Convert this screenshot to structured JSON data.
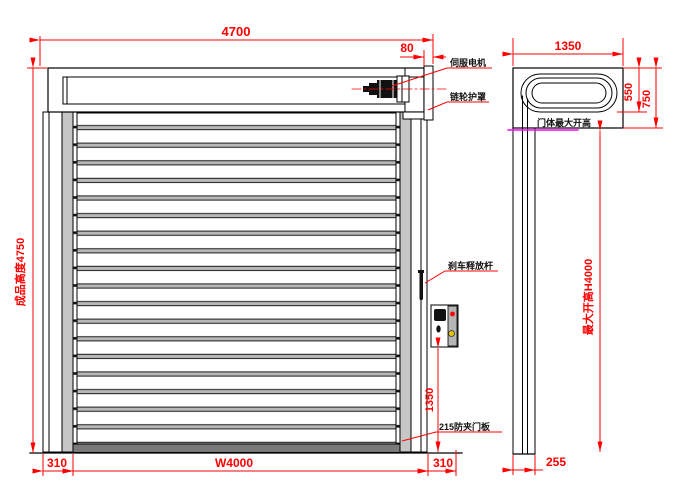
{
  "title": "高速卷帘门外形尺寸图",
  "front_view": {
    "dims": {
      "total_width": "4700",
      "bracket_width": "80",
      "product_height": "成品高度4750",
      "box_to_floor": "1350",
      "left_margin": "310",
      "opening_width": "W4000",
      "right_margin": "310"
    },
    "labels": {
      "servo_motor": "伺服电机",
      "sprocket_guard": "链轮护罩",
      "brake_release": "刹车释放杆",
      "door_panel": "215防夹门板"
    }
  },
  "side_view": {
    "dims": {
      "depth": "1350",
      "box_inner_height": "550",
      "box_total_height": "750",
      "max_opening_height": "最大开高H4000",
      "column_depth": "255"
    },
    "labels": {
      "max_opening_line": "门体最大开高"
    }
  },
  "colors": {
    "dimension_red": "#ff0000",
    "outline_black": "#000000",
    "rail_gray": "#c6c6c6",
    "slat_band_gray": "#b8b8b8",
    "bottom_beam_gray": "#7a7a7a",
    "max_open_magenta": "#ff00ff",
    "button_yellow": "#e6c300",
    "button_red": "#ff0000"
  }
}
